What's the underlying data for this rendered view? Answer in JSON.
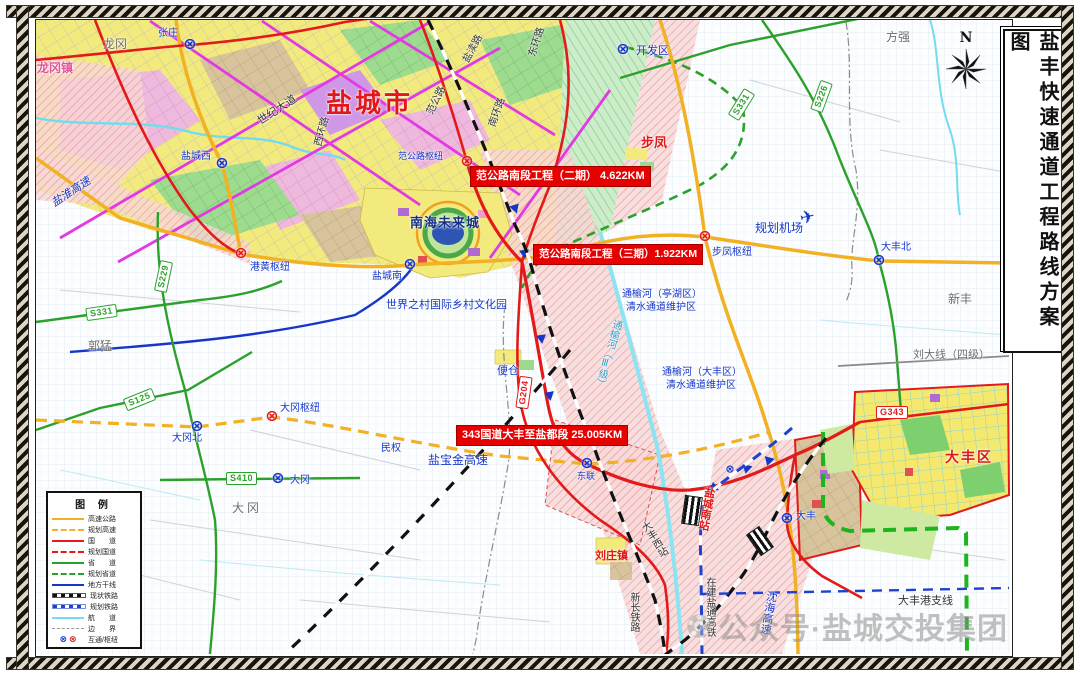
{
  "title": "盐丰快速通道工程路线方案图",
  "compass_label": "N",
  "icons": {
    "interchange": "⊗",
    "airplane": "✈"
  },
  "project_labels": {
    "phase2": "范公路南段工程（二期） 4.622KM",
    "phase3": "范公路南段工程（三期）1.922KM",
    "g343_section": "343国道大丰至盐都段  25.005KM"
  },
  "shields": {
    "s229": "S229",
    "s331_west": "S331",
    "s331_east": "S331",
    "s125": "S125",
    "s410": "S410",
    "s226": "S226",
    "g204": "G204",
    "g343": "G343"
  },
  "legend": {
    "title": "图 例",
    "items": [
      {
        "key": "expressway",
        "label": "高速公路"
      },
      {
        "key": "planned-expressway",
        "label": "规划高速"
      },
      {
        "key": "national-road",
        "label": "国　　道"
      },
      {
        "key": "planned-national-road",
        "label": "规划国道"
      },
      {
        "key": "provincial-road",
        "label": "省　　道"
      },
      {
        "key": "planned-provincial-road",
        "label": "规划省道"
      },
      {
        "key": "local-trunk",
        "label": "地方干线"
      },
      {
        "key": "existing-railway",
        "label": "现状铁路"
      },
      {
        "key": "planned-railway",
        "label": "规划铁路"
      },
      {
        "key": "waterway",
        "label": "航　　道"
      },
      {
        "key": "boundary",
        "label": "边　　界"
      },
      {
        "key": "interchange-hub",
        "label": "互通/枢纽"
      }
    ]
  },
  "labels": {
    "yancheng_city": "盐城市",
    "longgang": "龙冈",
    "longgang_town": "龙冈镇",
    "zhangzhuang": "张庄",
    "yancheng_west": "盐城西",
    "yanhuai_expressway": "盐淮高速",
    "shiji_avenue": "世纪大道",
    "yandu_road": "盐渎路",
    "east_ring_road": "东环路",
    "south_ring_road": "南环路",
    "fangong_road": "范公路",
    "west_ring_road": "西环路",
    "fangong_hub": "范公路枢纽",
    "kaifaqu": "开发区",
    "bufeng": "步凤",
    "fangqiang": "方强",
    "planned_airport": "规划机场",
    "dafeng_north": "大丰北",
    "xinfeng": "新丰",
    "liuda_line": "刘大线（四级）",
    "dafeng_district": "大丰区",
    "tongyu_tinghu_line1": "通榆河（亭湖区）",
    "tongyu_tinghu_line2": "清水通道维护区",
    "tongyu_dafeng_line1": "通榆河（大丰区）",
    "tongyu_dafeng_line2": "清水通道维护区",
    "tongyu_river": "通榆河（Ⅲ级）",
    "bufeng_hub": "步凤枢纽",
    "guomeng": "郭猛",
    "minquan": "民权",
    "dagang_hub": "大冈枢纽",
    "dagang_north": "大冈北",
    "dagang_ic": "大冈",
    "dagang_town": "大冈",
    "yanbaojin_expressway": "盐宝金高速",
    "donglian": "东联",
    "biancang": "便仓",
    "liuzhuang_town": "刘庄镇",
    "dafeng_west_station": "大丰西站",
    "yantong_hsr": "在建盐通高铁",
    "xinchang_railway": "新长铁路",
    "shenhai_expressway": "沈海高速",
    "dafeng_port_branch": "大丰港支线",
    "yancheng_south_station": "盐城南站",
    "dafeng_ic": "大丰",
    "yancheng_south_ic": "盐城南",
    "ganghuang_hub": "港黄枢纽",
    "nanhai_city": "南海未来城",
    "world_village": "世界之村国际乡村文化园"
  },
  "watermark": "公众号·盐城交投集团",
  "colors": {
    "expressway": "#f2b023",
    "national_road": "#e31a1a",
    "provincial_road": "#2ba12b",
    "local_trunk": "#1536c8",
    "city_artery": "#e23ae2",
    "waterway": "#72dcef",
    "existing_railway": "#111111",
    "planned_railway": "#2040d0",
    "project_highlight": "#e60000"
  }
}
